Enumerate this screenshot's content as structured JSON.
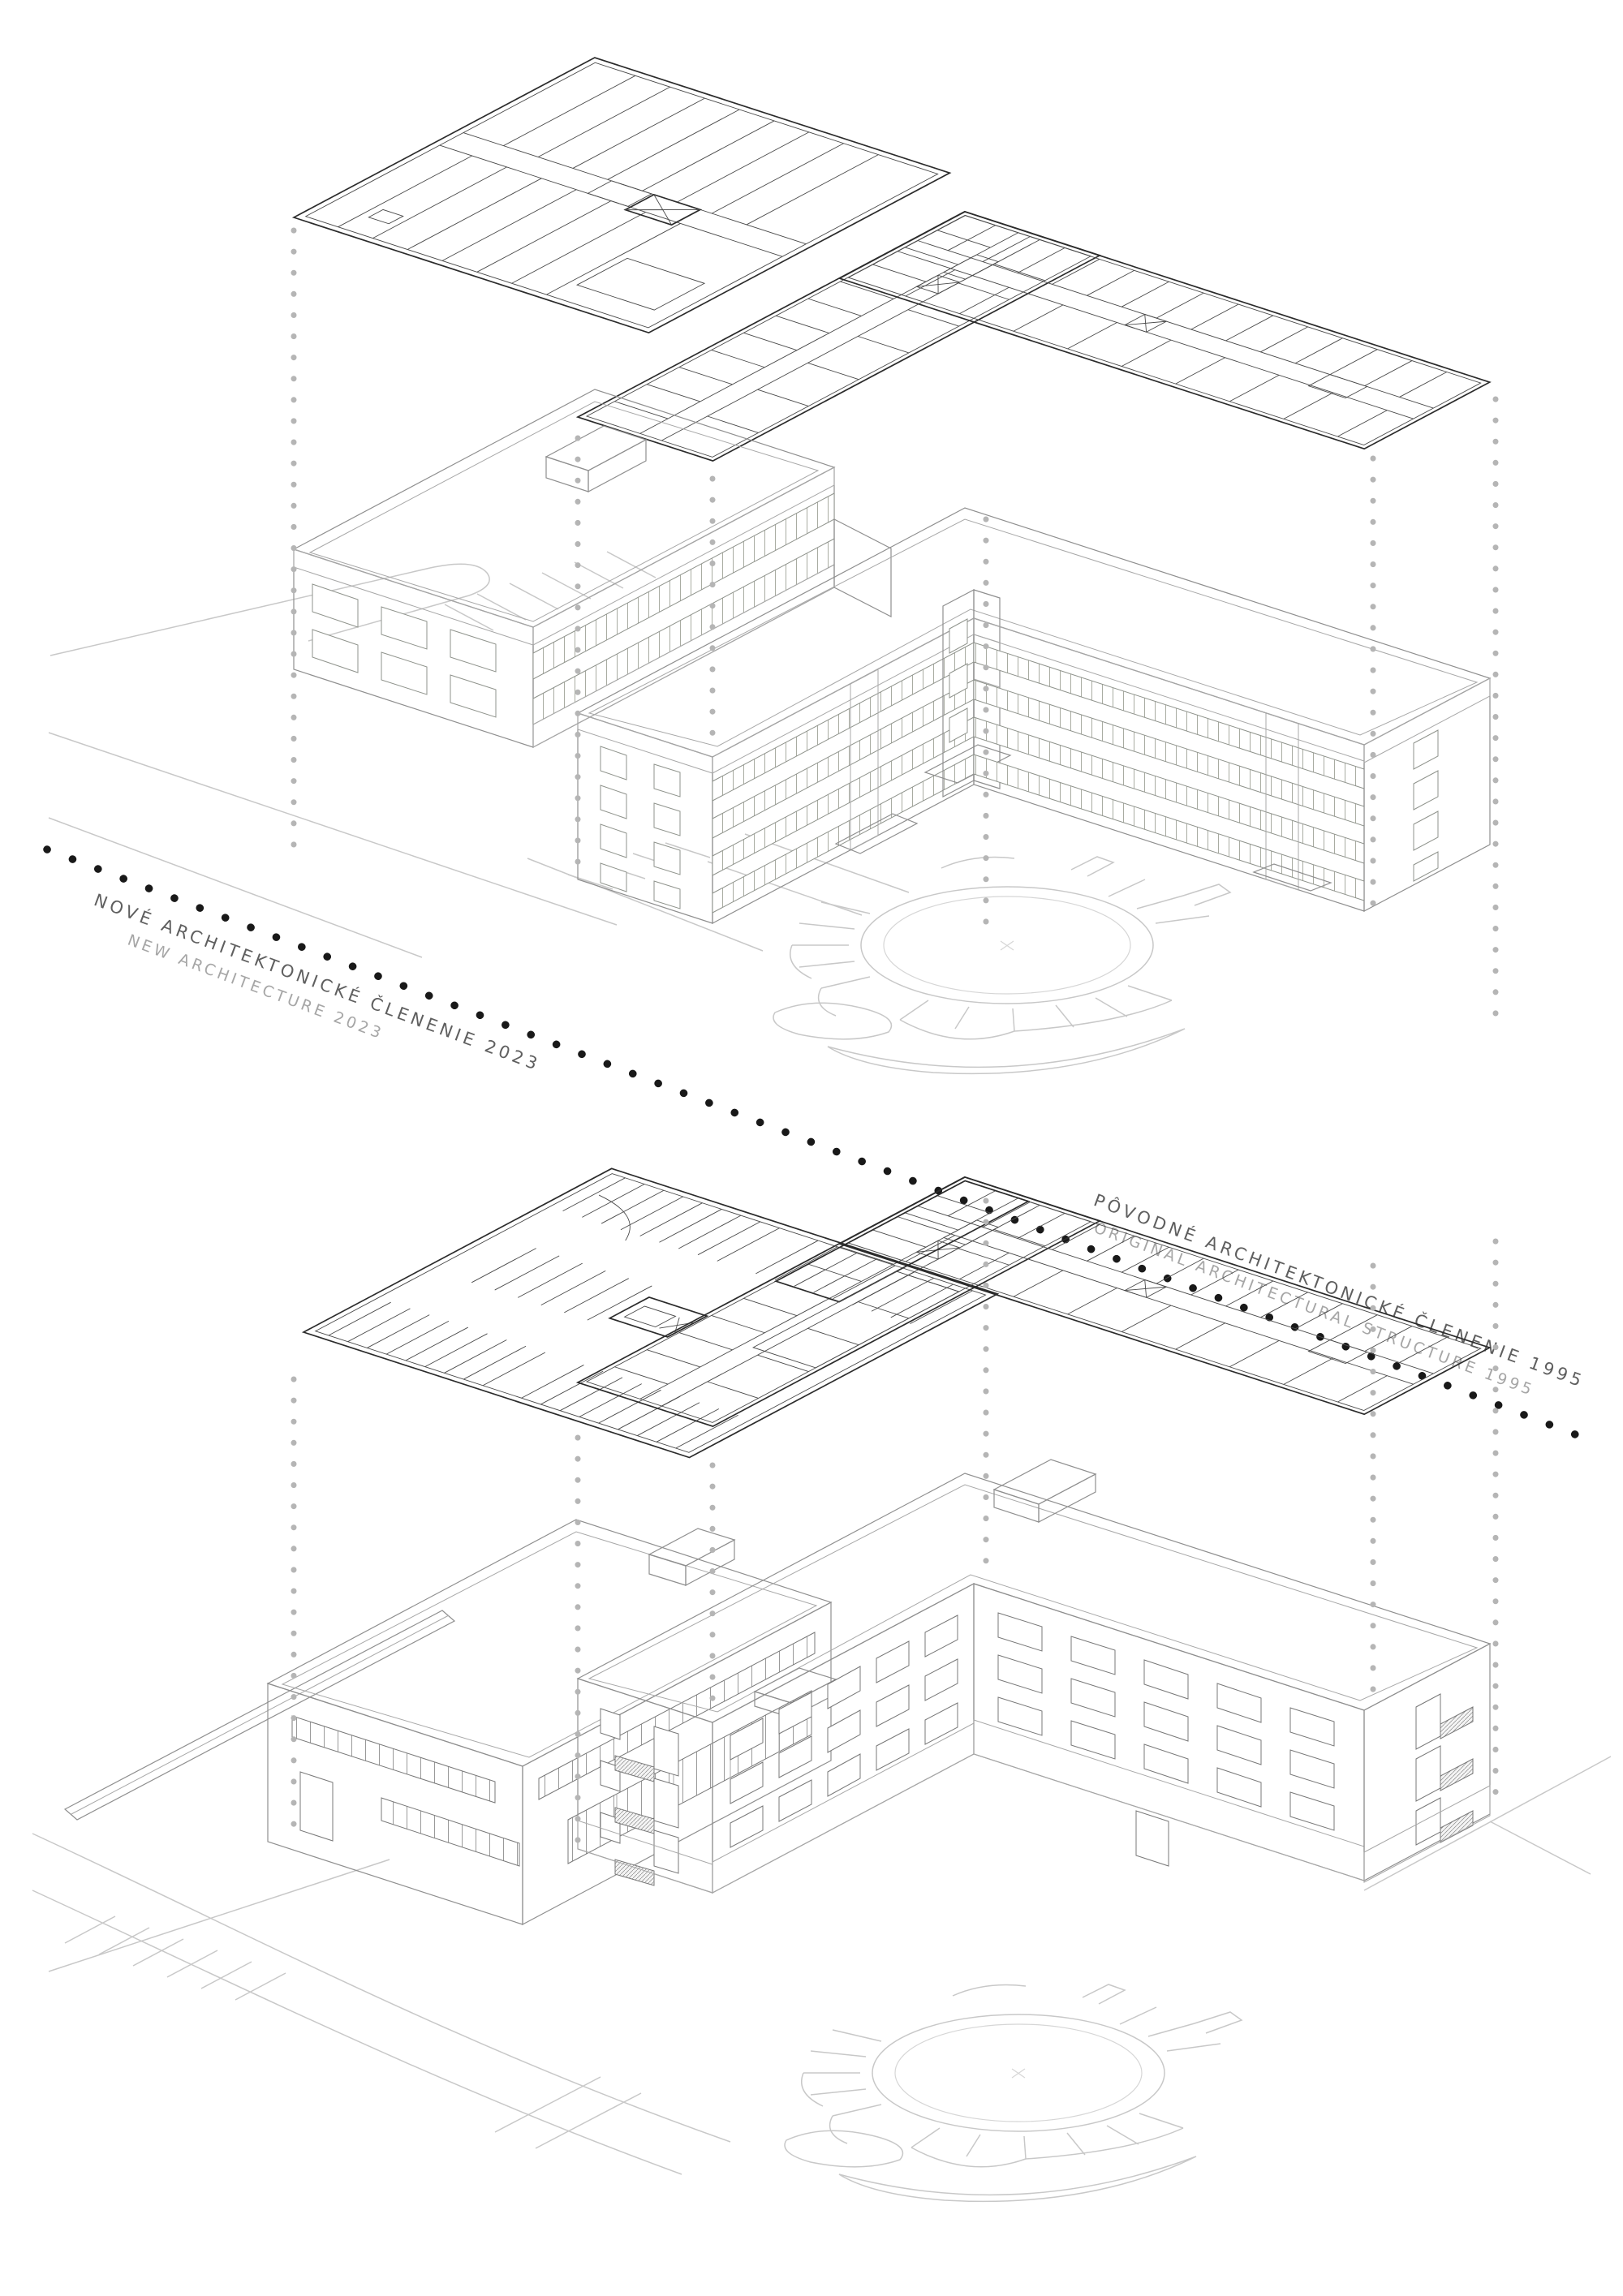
{
  "document": {
    "type": "architectural-axonometric-comparison-diagram",
    "background": "#ffffff"
  },
  "sections": [
    {
      "id": "new-architecture",
      "label_sk": "NOVÉ ARCHITEKTONICKÉ ČLENENIE 2023",
      "label_en": "NEW ARCHITECTURE 2023",
      "year": "2023",
      "accent_color": "#c5c8b4",
      "facade_light": "#f0f1ec"
    },
    {
      "id": "original-structure",
      "label_sk": "PÔVODNÉ ARCHITEKTONICKÉ ČLENENIE 1995",
      "label_en": "ORIGINAL ARCHITECTURAL STRUCTURE 1995",
      "year": "1995",
      "accent_color": "#d6d6d6",
      "facade_light": "#e7e7e7"
    }
  ],
  "divider": {
    "style": "dotted",
    "color": "#191919"
  },
  "palette": {
    "background": "#ffffff",
    "accent_new": "#c5c8b4",
    "fascia": "#e9eae3",
    "facade_white": "#f0f1ec",
    "gray_dark": "#c9c9c9",
    "gray_mid": "#d9d9d9",
    "gray_light": "#e4e4e4",
    "plan_lines": "#4a4a4a",
    "site_lines": "#c8c8c8",
    "projection_dots": "#b5b5b5",
    "divider_dots": "#191919"
  }
}
